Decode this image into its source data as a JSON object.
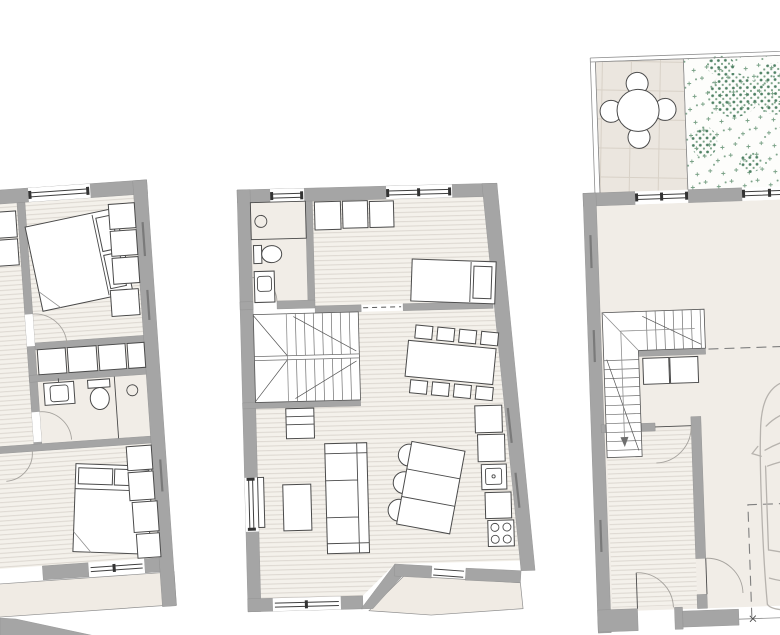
{
  "meta": {
    "title": "Architectural floor plans - three stacked levels of a townhouse",
    "sheet_width": 780,
    "sheet_height": 635
  },
  "colors": {
    "wall": "#a5a5a5",
    "wall-edge": "#8f8f8f",
    "floor": "#f1ede7",
    "floor-wood": "#f4f1eb",
    "hatch-line": "#dcd7d0",
    "tile-bg": "#ebe6df",
    "tile-line": "#d8d1c7",
    "paving": "#f0ebe4",
    "garden-bg": "#fdfdfb",
    "garden-green": "#79a186",
    "garden-green-dark": "#4f8164",
    "line": "#4a4a4a",
    "line-light": "#8f8f8f",
    "car-line": "#b7b3ae"
  },
  "plans": [
    {
      "id": "upper-floor-plan",
      "rooms": [
        "bedroom-1",
        "cut-off-room",
        "hallway",
        "closet-row",
        "bathroom",
        "bedroom-2",
        "balcony"
      ],
      "furniture": [
        "double-bed-1",
        "wardrobe-column",
        "built-in-closets",
        "washbasin",
        "toilet",
        "shower",
        "double-bed-2",
        "nightstand-column"
      ]
    },
    {
      "id": "middle-floor-plan",
      "rooms": [
        "bathroom",
        "bedroom",
        "stair-hall",
        "dining-area",
        "living-area",
        "kitchen",
        "outdoor-paving"
      ],
      "furniture": [
        "shower",
        "toilet",
        "washbasin",
        "closet-row",
        "single-bed",
        "u-staircase",
        "sideboard",
        "dining-table-8-chairs",
        "tv",
        "coffee-table",
        "straight-sofa",
        "angled-sofa",
        "kitchen-counter",
        "kitchen-sink",
        "cooktop"
      ]
    },
    {
      "id": "ground-floor-plan",
      "rooms": [
        "roof-terrace",
        "garden-bed",
        "entry-hall",
        "staircase",
        "corridor",
        "garage"
      ],
      "furniture": [
        "patio-table-4-chairs",
        "l-staircase",
        "hall-cabinets",
        "entry-door",
        "car",
        "parking-bay-outline"
      ]
    }
  ]
}
